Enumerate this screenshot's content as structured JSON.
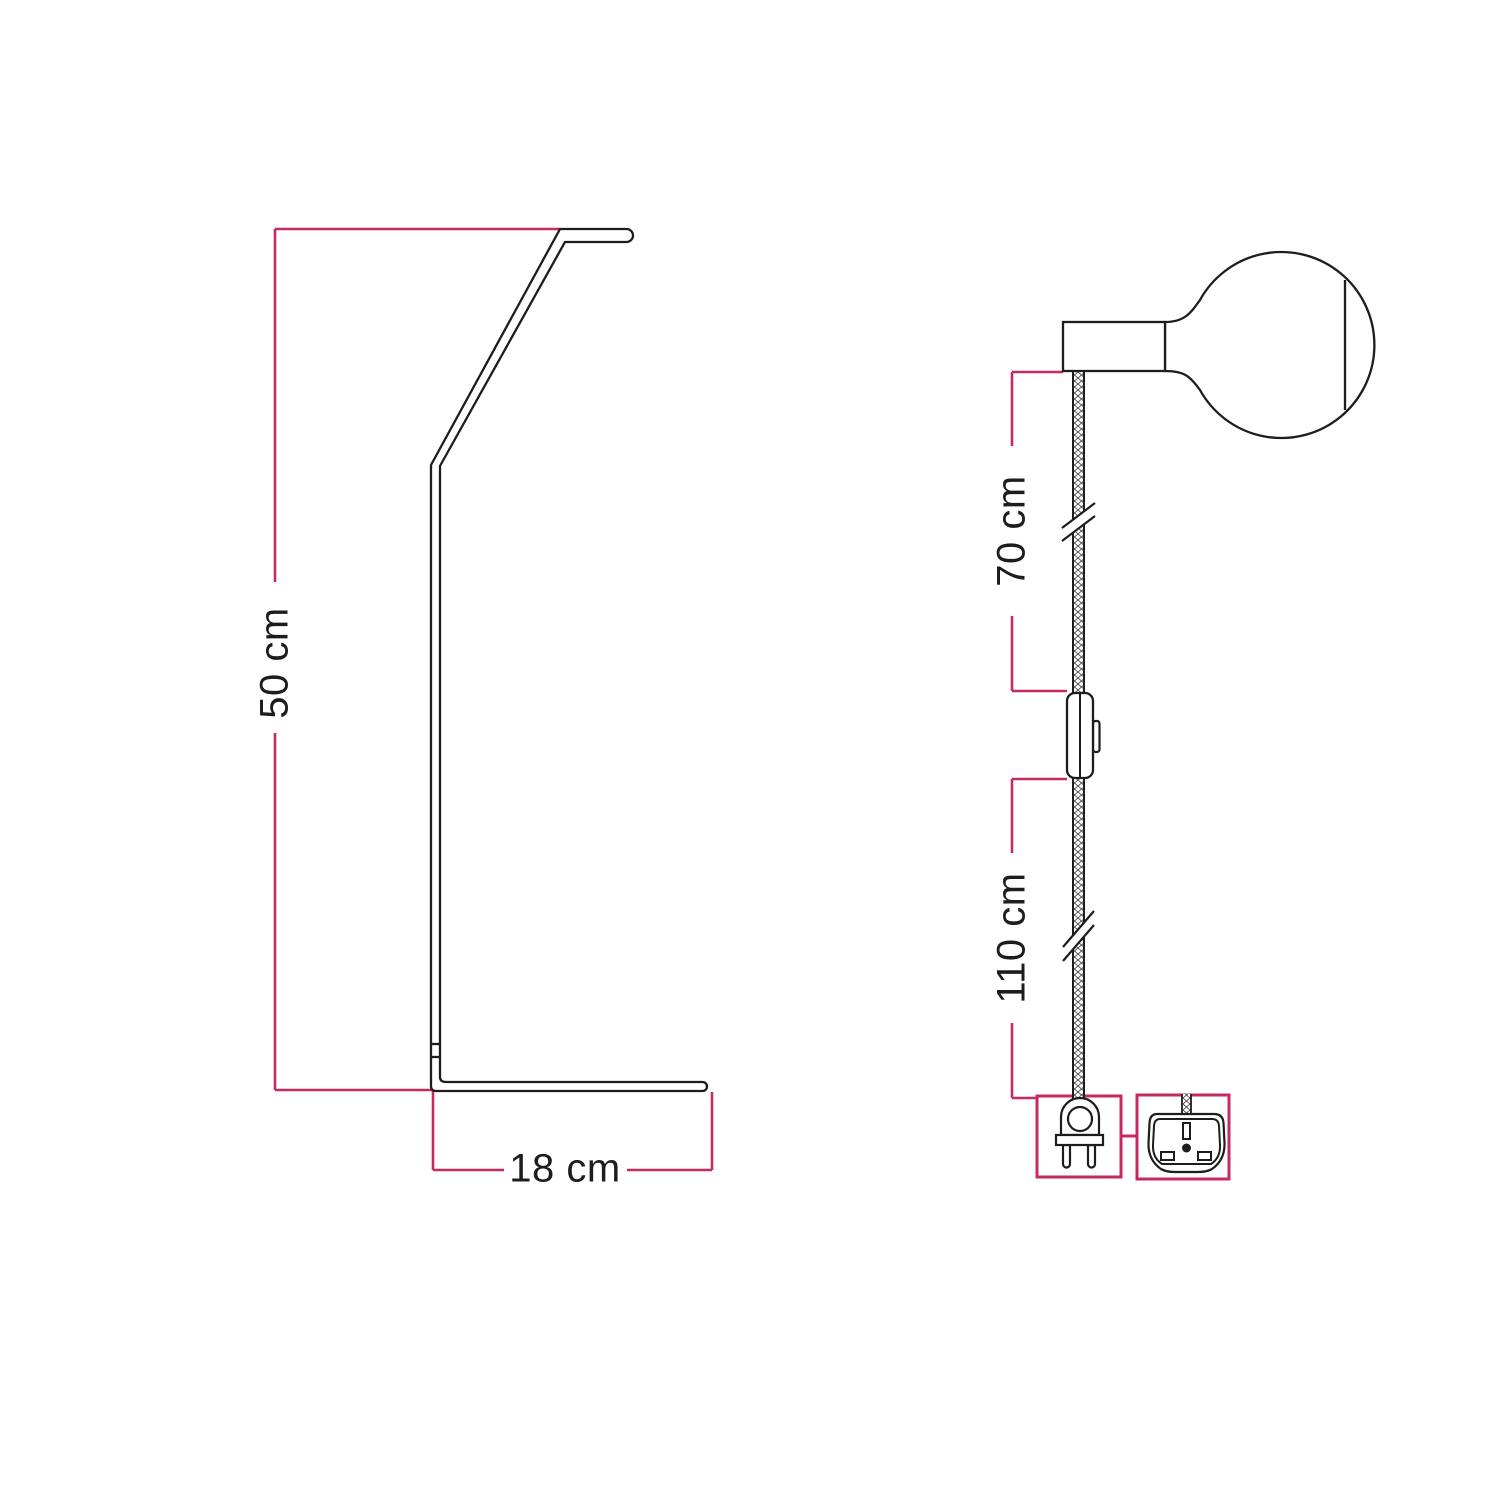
{
  "diagram": {
    "type": "product-dimension-drawing",
    "background": "#ffffff",
    "colors": {
      "dimension_line": "#c72a62",
      "drawing_line": "#1d1d1b"
    },
    "labels": {
      "stand_height": "50 cm",
      "base_depth": "18 cm",
      "socket_to_switch": "70 cm",
      "switch_to_plug": "110 cm"
    },
    "views": [
      {
        "id": "stand-profile",
        "description": "Side profile outline of angled lamp stand",
        "dimensions": [
          {
            "label": "50 cm",
            "measures": "overall stand height"
          },
          {
            "label": "18 cm",
            "measures": "base depth"
          }
        ]
      },
      {
        "id": "pendant-lamp",
        "description": "Socket with globe bulb, textile cable, inline switch, plug options",
        "dimensions": [
          {
            "label": "70 cm",
            "measures": "cable length from socket to switch"
          },
          {
            "label": "110 cm",
            "measures": "cable length from switch to plug"
          }
        ],
        "icons": [
          "globe-bulb-icon",
          "lamp-socket-icon",
          "cable-break-icon",
          "inline-switch-icon",
          "eu-two-pin-plug-icon",
          "uk-three-pin-plug-icon"
        ]
      }
    ]
  }
}
